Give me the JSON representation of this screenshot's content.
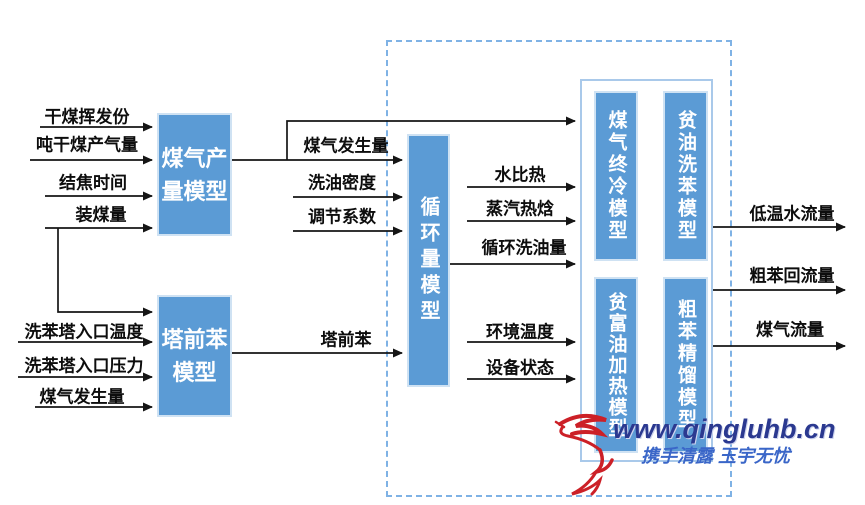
{
  "models": {
    "gas_production": "煤气产量模型",
    "tower_front_benzene": "塔前苯模型",
    "circulation": "循环量模型",
    "gas_final_cooling": "煤气终冷模型",
    "lean_oil_benzene_washing": "贫油洗苯模型",
    "lean_rich_oil_heating": "贫富油加热模型",
    "crude_benzene_distillation": "粗苯精馏模型"
  },
  "inputs_top": {
    "dry_coal_volatile": "干煤挥发份",
    "gas_yield_per_ton": "吨干煤产气量",
    "coking_time": "结焦时间",
    "coal_charge": "装煤量"
  },
  "inputs_bottom": {
    "washer_inlet_temperature": "洗苯塔入口温度",
    "washer_inlet_pressure": "洗苯塔入口压力",
    "gas_generation": "煤气发生量"
  },
  "mid_labels": {
    "gas_generation": "煤气发生量",
    "wash_oil_density": "洗油密度",
    "adjustment_coefficient": "调节系数",
    "tower_front_benzene": "塔前苯",
    "water_specific_heat": "水比热",
    "steam_enthalpy": "蒸汽热焓",
    "circulating_wash_oil": "循环洗油量",
    "ambient_temperature": "环境温度",
    "equipment_status": "设备状态"
  },
  "outputs": {
    "low_temp_water_flow": "低温水流量",
    "crude_benzene_reflux": "粗苯回流量",
    "gas_flow": "煤气流量"
  },
  "watermark": {
    "url": "www.qingluhb.cn",
    "tagline": "携手清露 玉宇无忧"
  },
  "colors": {
    "model_fill": "#5B9BD5",
    "dashed_border": "#7FB2E5",
    "group_border": "#A9C9EA",
    "arrow": "#151515",
    "watermark_url": "#2B3990",
    "watermark_tagline": "#3A66C8",
    "bird_red": "#CC2027"
  }
}
